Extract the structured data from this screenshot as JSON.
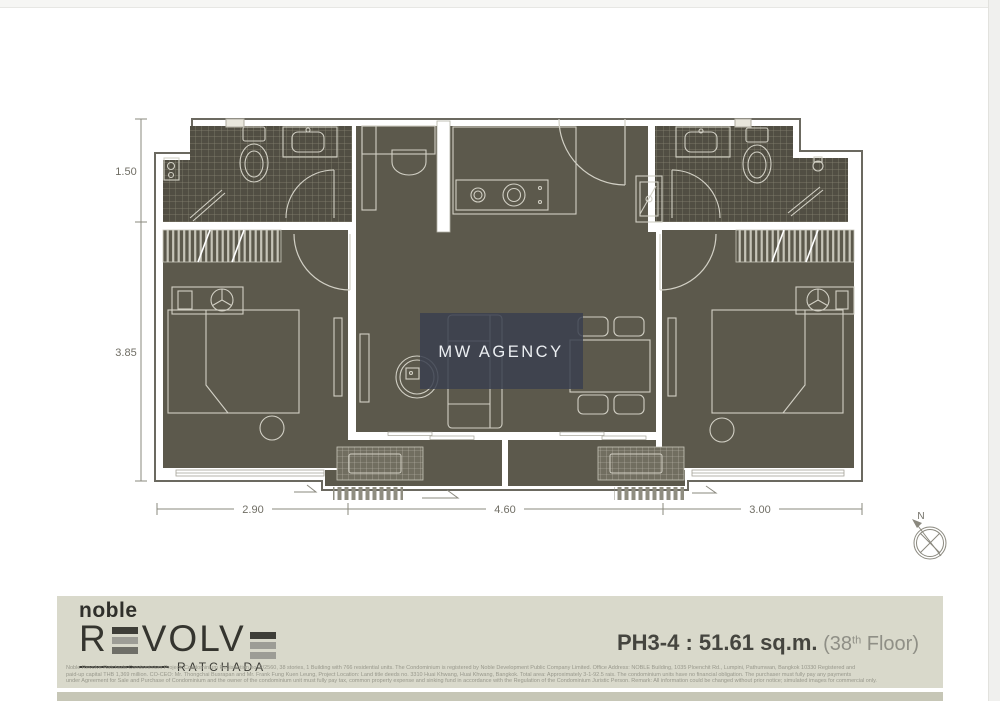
{
  "plan": {
    "watermark": "MW AGENCY",
    "compass": "N",
    "dims_left": [
      "1.50",
      "3.85"
    ],
    "dims_bottom": [
      "2.90",
      "4.60",
      "3.00"
    ]
  },
  "footer": {
    "logo": {
      "brand": "noble",
      "l1": "R",
      "l2": "VOLV",
      "subtitle": "RATCHADA"
    },
    "unit": {
      "main": "PH3-4 : 51.61 sq.m.",
      "floor_open": " (38",
      "floor_sup": "th",
      "floor_close": " Floor)"
    },
    "disclaimer": {
      "line1": "Noble Revolve Ratchada Condominium Project. Condominium Registration no: 2/2560, 38 stories, 1 Building with 766 residential units. The Condominium is registered by Noble Development Public Company Limited. Office Address: NOBLE Building, 1035 Ploenchit Rd., Lumpini, Pathumwan, Bangkok 10330 Registered and",
      "line2": "paid-up capital THB 1,369 million. CO-CEO: Mr. Thongchai Busrapan and Mr. Frank Fung Kuen Leung, Project Location: Land title deeds no. 3310 Huai Khwang, Huai Khwang, Bangkok. Total area: Approximately 3-1-92.5 rais. The condominium units have no financial obligation. The purchaser must fully pay any payments",
      "line3": "under Agreement for Sale and Purchase of Condominium and the owner of the condominium unit must fully pay tax, common property expense and sinking fund in accordance with the Regulation of the Condominium Juristic Person. Remark: All information could be changed without prior notice; simulated images for commercial only."
    }
  },
  "colors": {
    "floor_dark": "#5c594c",
    "tile_base": "#514e43",
    "footer_bg": "#d9d9cb",
    "footer_strip": "#c6c6b6",
    "accent_dark": "#3a3a35",
    "watermark_bg": "#39404f"
  }
}
